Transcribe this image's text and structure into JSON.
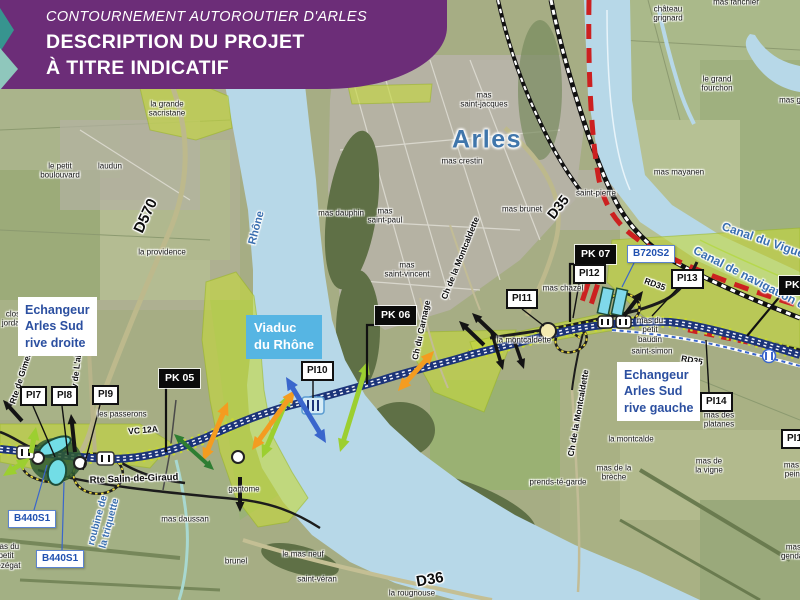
{
  "banner": {
    "line1": "CONTOURNEMENT AUTOROUTIER D'ARLES",
    "line2": "DESCRIPTION DU PROJET",
    "line3": "À TITRE INDICATIF"
  },
  "map": {
    "city": "Arles"
  },
  "colors": {
    "banner": "#6c2d78",
    "accent_blue": "#2b4fa0",
    "viaduc_bg": "#56b5e3",
    "motorway": "#1c3479",
    "project_green": "#c5d83c",
    "water": "#b7d8e8",
    "orange": "#f49c20",
    "green": "#9ccf30",
    "darkgreen": "#2e7d32",
    "blue": "#3a66cc",
    "black": "#141414",
    "red_line": "#cc2020"
  },
  "info_boxes": [
    {
      "id": "viaduc-du-rhone",
      "type": "cyan",
      "x": 246,
      "y": 315,
      "text": "Viaduc\ndu Rhône"
    },
    {
      "id": "echangeur-arles-sud-rive-droite",
      "type": "white",
      "x": 18,
      "y": 297,
      "text": "Echangeur\nArles Sud\nrive droite"
    },
    {
      "id": "echangeur-arles-sud-rive-gauche",
      "type": "white",
      "x": 617,
      "y": 362,
      "text": "Echangeur\nArles Sud\nrive gauche"
    }
  ],
  "pk_markers": [
    {
      "label": "PK 05",
      "x": 159,
      "y": 369,
      "leader": [
        [
          166,
          388
        ],
        [
          166,
          452
        ]
      ]
    },
    {
      "label": "PK 06",
      "x": 375,
      "y": 306,
      "leader": [
        [
          378,
          325
        ],
        [
          367,
          325
        ],
        [
          367,
          384
        ]
      ]
    },
    {
      "label": "PK 07",
      "x": 575,
      "y": 245,
      "leader": [
        [
          578,
          264
        ],
        [
          570,
          264
        ],
        [
          570,
          322
        ]
      ]
    },
    {
      "label": "PK 08",
      "x": 779,
      "y": 276,
      "leader": [
        [
          781,
          295
        ],
        [
          747,
          336
        ]
      ]
    }
  ],
  "pi_markers": [
    {
      "label": "PI7",
      "x": 20,
      "y": 386,
      "leader": [
        [
          33,
          406
        ],
        [
          55,
          457
        ]
      ]
    },
    {
      "label": "PI8",
      "x": 51,
      "y": 386,
      "leader": [
        [
          62,
          406
        ],
        [
          68,
          455
        ]
      ]
    },
    {
      "label": "PI9",
      "x": 92,
      "y": 385,
      "leader": [
        [
          100,
          405
        ],
        [
          83,
          470
        ]
      ]
    },
    {
      "label": "PI10",
      "x": 301,
      "y": 361,
      "leader": [
        [
          313,
          381
        ],
        [
          313,
          398
        ]
      ]
    },
    {
      "label": "PI11",
      "x": 506,
      "y": 289,
      "leader": [
        [
          522,
          309
        ],
        [
          544,
          326
        ]
      ]
    },
    {
      "label": "PI12",
      "x": 573,
      "y": 264,
      "leader": [
        [
          579,
          284
        ],
        [
          573,
          318
        ]
      ]
    },
    {
      "label": "PI13",
      "x": 671,
      "y": 269,
      "leader": [
        [
          677,
          289
        ],
        [
          652,
          316
        ]
      ]
    },
    {
      "label": "PI14",
      "x": 700,
      "y": 392,
      "leader": [
        [
          709,
          392
        ],
        [
          706,
          340
        ]
      ]
    },
    {
      "label": "PI15",
      "x": 781,
      "y": 429,
      "leader": []
    }
  ],
  "b_markers": [
    {
      "label": "B440S1",
      "x": 8,
      "y": 510,
      "leader": [
        [
          34,
          510
        ],
        [
          47,
          465
        ]
      ]
    },
    {
      "label": "B440S1",
      "x": 36,
      "y": 550,
      "leader": [
        [
          62,
          550
        ],
        [
          64,
          482
        ]
      ]
    },
    {
      "label": "B720S2",
      "x": 627,
      "y": 245,
      "leader": [
        [
          634,
          263
        ],
        [
          622,
          287
        ]
      ]
    }
  ],
  "road_labels": [
    {
      "t": "D570",
      "x": 146,
      "y": 216,
      "rot": -65,
      "size": 15
    },
    {
      "t": "D35",
      "x": 558,
      "y": 207,
      "rot": -52,
      "size": 14
    },
    {
      "t": "D36",
      "x": 430,
      "y": 580,
      "rot": -10,
      "size": 15
    },
    {
      "t": "RD35",
      "x": 655,
      "y": 284,
      "rot": 20,
      "size": 8.5
    },
    {
      "t": "RD35",
      "x": 692,
      "y": 360,
      "rot": 10,
      "size": 8.5
    },
    {
      "t": "VC 12A",
      "x": 143,
      "y": 430,
      "rot": -5,
      "size": 8.5
    },
    {
      "t": "Rte Salin-de-Giraud",
      "x": 134,
      "y": 479,
      "rot": -2,
      "size": 9.5
    },
    {
      "t": "Av de L'abbé Pierre",
      "x": 78,
      "y": 355,
      "rot": -83,
      "size": 8.5
    },
    {
      "t": "Rte de Gimeaux",
      "x": 22,
      "y": 373,
      "rot": -72,
      "size": 8.5
    },
    {
      "t": "Ch de la Montcaldette",
      "x": 460,
      "y": 258,
      "rot": -68,
      "size": 8.5
    },
    {
      "t": "Ch de la Montcaldette",
      "x": 578,
      "y": 413,
      "rot": -80,
      "size": 8.5
    },
    {
      "t": "Ch du Carnage",
      "x": 421,
      "y": 330,
      "rot": -78,
      "size": 8.5
    }
  ],
  "water_labels": [
    {
      "t": "Rhône",
      "x": 257,
      "y": 228,
      "rot": -75,
      "size": 11
    },
    {
      "t": "roubine de\nla triquette",
      "x": 104,
      "y": 522,
      "rot": -75,
      "size": 10
    },
    {
      "t": "Canal du Vigueirat",
      "x": 772,
      "y": 243,
      "rot": 19,
      "size": 12
    },
    {
      "t": "Canal de navigation d'Arles",
      "x": 764,
      "y": 285,
      "rot": 27,
      "size": 12
    }
  ],
  "place_labels": [
    {
      "t": "mas\nsaint-jacques",
      "x": 484,
      "y": 100
    },
    {
      "t": "mas crestin",
      "x": 462,
      "y": 161
    },
    {
      "t": "saint-pierre",
      "x": 596,
      "y": 193
    },
    {
      "t": "mas mayanen",
      "x": 679,
      "y": 172
    },
    {
      "t": "mas brunet",
      "x": 522,
      "y": 209
    },
    {
      "t": "mas dauphin",
      "x": 341,
      "y": 213
    },
    {
      "t": "mas\nsaint-paul",
      "x": 385,
      "y": 216
    },
    {
      "t": "mas\nsaint-vincent",
      "x": 407,
      "y": 270
    },
    {
      "t": "mas chazel",
      "x": 563,
      "y": 288
    },
    {
      "t": "la montcaldette",
      "x": 524,
      "y": 340
    },
    {
      "t": "la montcalde",
      "x": 631,
      "y": 439
    },
    {
      "t": "mas de la\nbrèche",
      "x": 614,
      "y": 473
    },
    {
      "t": "prends-té-garde",
      "x": 558,
      "y": 482
    },
    {
      "t": "mas des\nplatanes",
      "x": 719,
      "y": 420
    },
    {
      "t": "mas de\nla vigne",
      "x": 709,
      "y": 466
    },
    {
      "t": "mas du\npetit\nbaudin",
      "x": 650,
      "y": 330
    },
    {
      "t": "saint-simon",
      "x": 652,
      "y": 351
    },
    {
      "t": "château\ngrignard",
      "x": 668,
      "y": 14
    },
    {
      "t": "mas fanchier",
      "x": 736,
      "y": 2
    },
    {
      "t": "le grand\nfourchon",
      "x": 717,
      "y": 84
    },
    {
      "t": "mas g",
      "x": 790,
      "y": 100
    },
    {
      "t": "le petit\nboulouvard",
      "x": 60,
      "y": 171
    },
    {
      "t": "laudun",
      "x": 110,
      "y": 166
    },
    {
      "t": "la grande\nsacristane",
      "x": 167,
      "y": 109
    },
    {
      "t": "la providence",
      "x": 162,
      "y": 252
    },
    {
      "t": "clos\njordan",
      "x": 13,
      "y": 319
    },
    {
      "t": "les passerons",
      "x": 122,
      "y": 414
    },
    {
      "t": "mas daussan",
      "x": 185,
      "y": 519
    },
    {
      "t": "mas du\npetit\ntrézégat",
      "x": 6,
      "y": 556
    },
    {
      "t": "brunel",
      "x": 236,
      "y": 561
    },
    {
      "t": "le mas neuf",
      "x": 303,
      "y": 554
    },
    {
      "t": "saint-véran",
      "x": 317,
      "y": 579
    },
    {
      "t": "la rougnouse",
      "x": 412,
      "y": 593
    },
    {
      "t": "gantome",
      "x": 244,
      "y": 489
    },
    {
      "t": "mas du\npeintre",
      "x": 797,
      "y": 470
    },
    {
      "t": "mas du\ngendarme",
      "x": 799,
      "y": 552
    }
  ],
  "arrows": [
    {
      "c": "orange",
      "x1": 203,
      "y1": 461,
      "x2": 228,
      "y2": 402,
      "heads": 2,
      "w": 5
    },
    {
      "c": "green",
      "x1": 262,
      "y1": 458,
      "x2": 290,
      "y2": 393,
      "heads": 2,
      "w": 5
    },
    {
      "c": "orange",
      "x1": 252,
      "y1": 450,
      "x2": 295,
      "y2": 390,
      "heads": 2,
      "w": 5
    },
    {
      "c": "green",
      "x1": 340,
      "y1": 452,
      "x2": 368,
      "y2": 361,
      "heads": 2,
      "w": 5
    },
    {
      "c": "orange",
      "x1": 398,
      "y1": 391,
      "x2": 434,
      "y2": 351,
      "heads": 2,
      "w": 5
    },
    {
      "c": "blue",
      "x1": 286,
      "y1": 377,
      "x2": 326,
      "y2": 443,
      "heads": 2,
      "w": 5
    },
    {
      "c": "green",
      "x1": 3,
      "y1": 476,
      "x2": 30,
      "y2": 458,
      "heads": 2,
      "w": 5
    },
    {
      "c": "green",
      "x1": 31,
      "y1": 453,
      "x2": 36,
      "y2": 427,
      "heads": 1,
      "w": 5
    },
    {
      "c": "darkgreen",
      "x1": 174,
      "y1": 434,
      "x2": 214,
      "y2": 470,
      "heads": 2,
      "w": 4
    },
    {
      "c": "black",
      "x1": 22,
      "y1": 421,
      "x2": 3,
      "y2": 400,
      "heads": 1,
      "w": 4
    },
    {
      "c": "black",
      "x1": 75,
      "y1": 452,
      "x2": 71,
      "y2": 414,
      "heads": 1,
      "w": 4
    },
    {
      "c": "black",
      "x1": 240,
      "y1": 477,
      "x2": 240,
      "y2": 512,
      "heads": 1,
      "w": 4
    },
    {
      "c": "black",
      "x1": 484,
      "y1": 345,
      "x2": 459,
      "y2": 321,
      "heads": 1,
      "w": 4
    },
    {
      "c": "black",
      "x1": 497,
      "y1": 337,
      "x2": 472,
      "y2": 313,
      "heads": 1,
      "w": 4
    },
    {
      "c": "black",
      "x1": 492,
      "y1": 333,
      "x2": 503,
      "y2": 370,
      "heads": 1,
      "w": 3.5
    },
    {
      "c": "black",
      "x1": 513,
      "y1": 337,
      "x2": 524,
      "y2": 369,
      "heads": 1,
      "w": 3.5
    },
    {
      "c": "black",
      "x1": 624,
      "y1": 316,
      "x2": 643,
      "y2": 291,
      "heads": 1,
      "w": 4
    }
  ]
}
